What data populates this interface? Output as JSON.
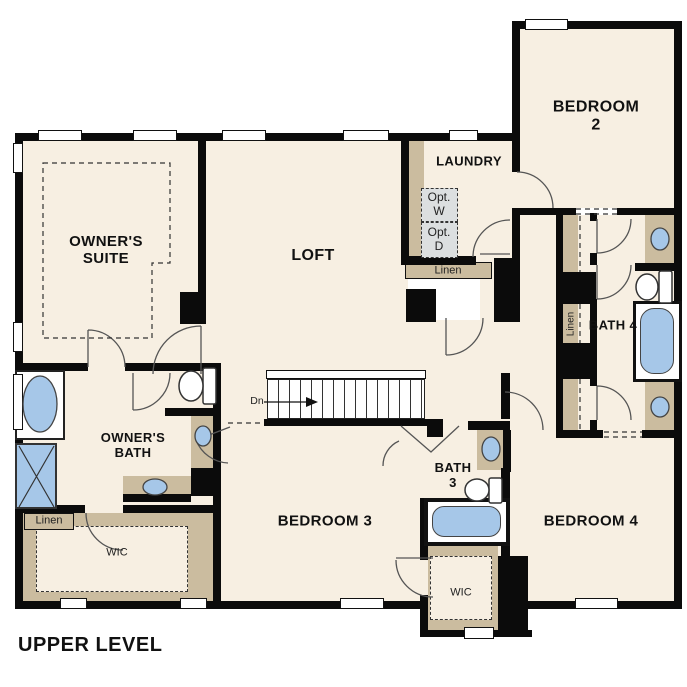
{
  "title": "UPPER LEVEL",
  "colors": {
    "floor": "#f7efe2",
    "wall": "#0b0b0b",
    "cabinet_tan": "#cbbc9f",
    "fixture_blue": "#a6c7e8",
    "optional_gray": "#dcdfe0",
    "line": "#444444"
  },
  "rooms": {
    "owners_suite": "OWNER'S\nSUITE",
    "loft": "LOFT",
    "laundry": "LAUNDRY",
    "bedroom_2": "BEDROOM 2",
    "bath_4": "BATH 4",
    "owners_bath": "OWNER'S\nBATH",
    "bath_3": "BATH\n3",
    "bedroom_3": "BEDROOM 3",
    "bedroom_4": "BEDROOM 4",
    "wic_owner": "WIC",
    "wic_hall": "WIC"
  },
  "annotations": {
    "linen_owner": "Linen",
    "linen_laundry": "Linen",
    "linen_bath4": "Linen",
    "opt_washer": "Opt.\nW",
    "opt_dryer": "Opt.\nD",
    "stairs_down": "Dn"
  }
}
